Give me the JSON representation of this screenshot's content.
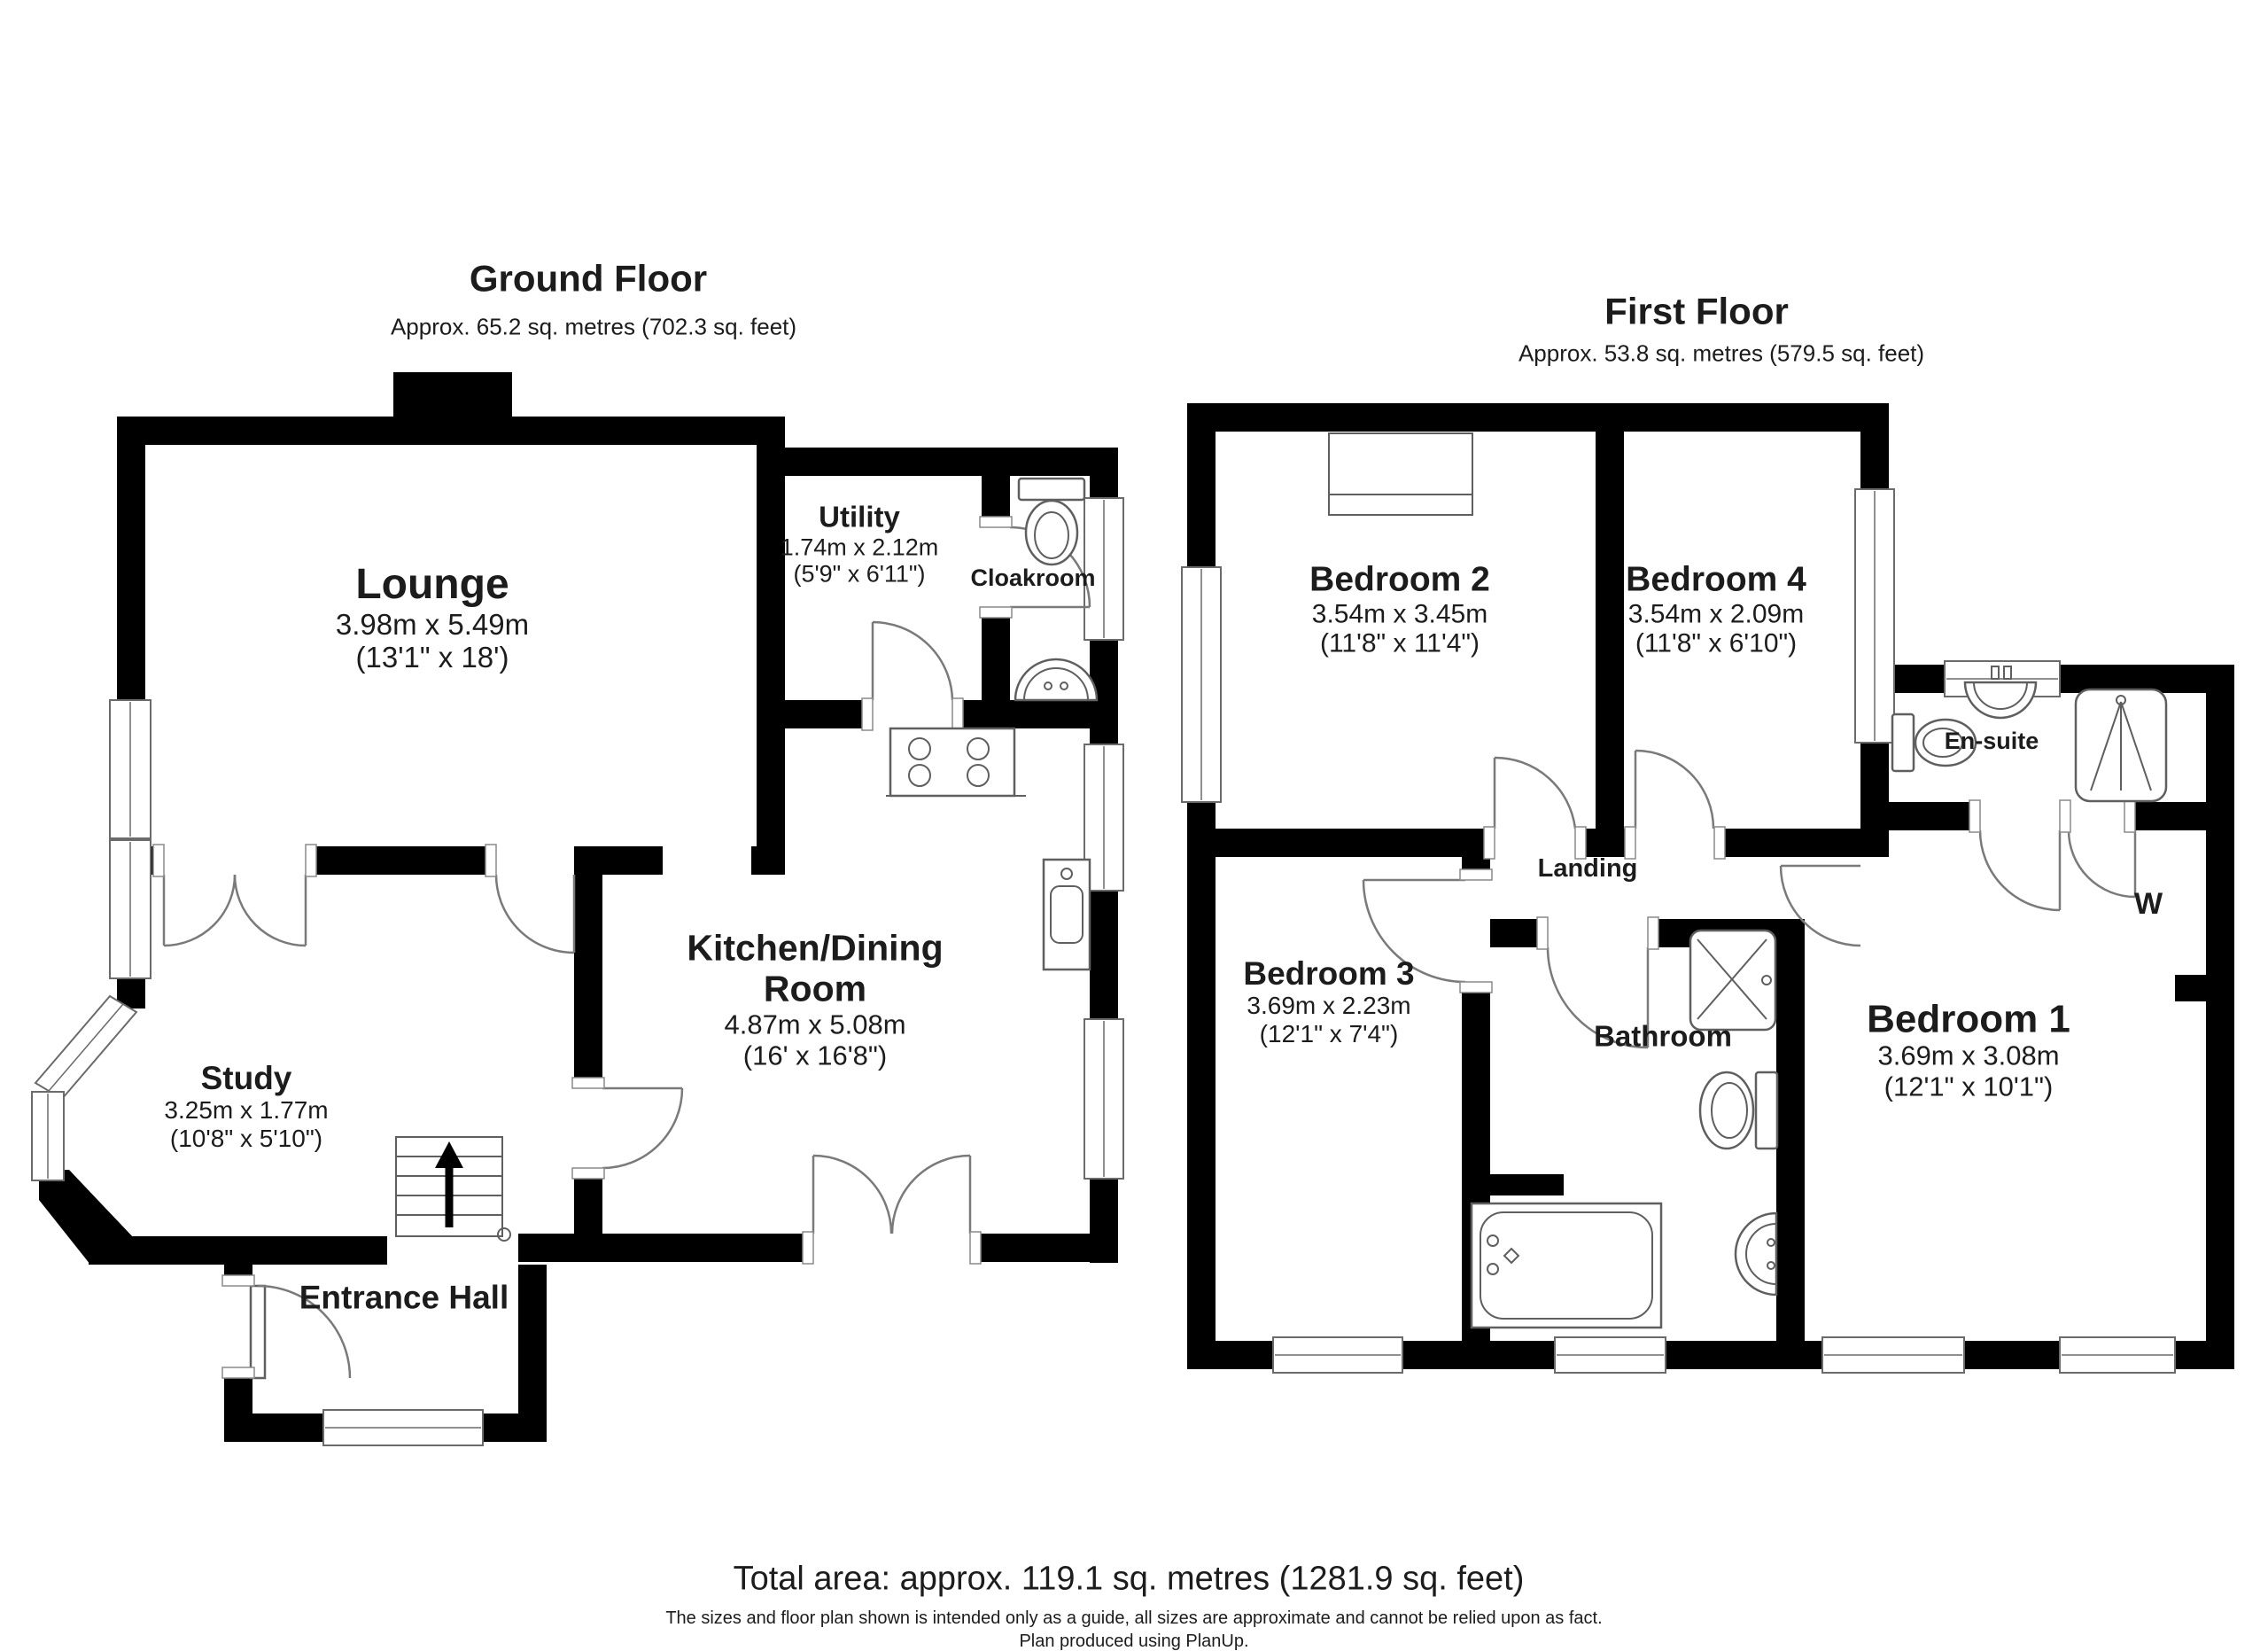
{
  "ground_floor": {
    "title": "Ground Floor",
    "subtitle": "Approx. 65.2 sq. metres (702.3 sq. feet)",
    "rooms": {
      "lounge": {
        "name": "Lounge",
        "metric": "3.98m x 5.49m",
        "imperial": "(13'1\" x 18')"
      },
      "utility": {
        "name": "Utility",
        "metric": "1.74m x 2.12m",
        "imperial": "(5'9\" x 6'11\")"
      },
      "cloakroom": {
        "name": "Cloakroom"
      },
      "kitchen": {
        "name": "Kitchen/Dining Room",
        "metric": "4.87m x 5.08m",
        "imperial": "(16' x 16'8\")"
      },
      "study": {
        "name": "Study",
        "metric": "3.25m x 1.77m",
        "imperial": "(10'8\" x 5'10\")"
      },
      "entrance": {
        "name": "Entrance Hall"
      }
    }
  },
  "first_floor": {
    "title": "First Floor",
    "subtitle": "Approx. 53.8 sq. metres (579.5 sq. feet)",
    "rooms": {
      "bedroom2": {
        "name": "Bedroom 2",
        "metric": "3.54m x 3.45m",
        "imperial": "(11'8\" x 11'4\")"
      },
      "bedroom4": {
        "name": "Bedroom 4",
        "metric": "3.54m x 2.09m",
        "imperial": "(11'8\" x 6'10\")"
      },
      "ensuite": {
        "name": "En-suite"
      },
      "landing": {
        "name": "Landing"
      },
      "bedroom3": {
        "name": "Bedroom 3",
        "metric": "3.69m x 2.23m",
        "imperial": "(12'1\" x 7'4\")"
      },
      "bathroom": {
        "name": "Bathroom"
      },
      "bedroom1": {
        "name": "Bedroom 1",
        "metric": "3.69m x 3.08m",
        "imperial": "(12'1\" x 10'1\")"
      },
      "wardrobe": {
        "name": "W"
      }
    }
  },
  "footer": {
    "total_area": "Total area: approx. 119.1 sq. metres (1281.9 sq. feet)",
    "disclaimer": "The sizes and floor plan shown is intended only as a guide, all sizes are approximate and cannot be relied upon as fact.",
    "credit": "Plan produced using PlanUp."
  },
  "colors": {
    "wall": "#000000",
    "fixture_line": "#5f5f5f",
    "text": "#1c1c1c",
    "background": "#ffffff"
  }
}
